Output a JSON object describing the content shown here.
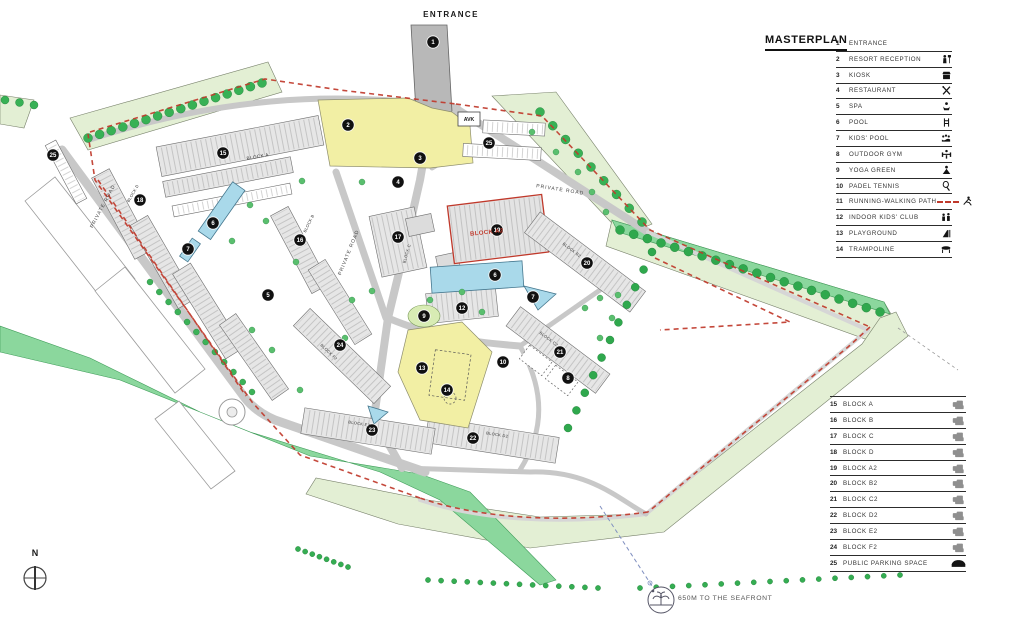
{
  "legend": {
    "title": "MASTERPLAN",
    "amenities": [
      {
        "n": "1",
        "label": "ENTRANCE",
        "icon": ""
      },
      {
        "n": "2",
        "label": "RESORT RECEPTION",
        "icon": "person"
      },
      {
        "n": "3",
        "label": "KIOSK",
        "icon": "kiosk"
      },
      {
        "n": "4",
        "label": "RESTAURANT",
        "icon": "restaurant"
      },
      {
        "n": "5",
        "label": "SPA",
        "icon": "spa"
      },
      {
        "n": "6",
        "label": "POOL",
        "icon": "pool"
      },
      {
        "n": "7",
        "label": "KIDS' POOL",
        "icon": "kids_pool"
      },
      {
        "n": "8",
        "label": "OUTDOOR GYM",
        "icon": "gym"
      },
      {
        "n": "9",
        "label": "YOGA GREEN",
        "icon": "yoga"
      },
      {
        "n": "10",
        "label": "PADEL TENNIS",
        "icon": "padel"
      },
      {
        "n": "11",
        "label": "RUNNING-WALKING PATH",
        "icon": "runner",
        "dashes": true
      },
      {
        "n": "12",
        "label": "INDOOR KIDS' CLUB",
        "icon": "kids_club"
      },
      {
        "n": "13",
        "label": "PLAYGROUND",
        "icon": "playground"
      },
      {
        "n": "14",
        "label": "TRAMPOLINE",
        "icon": "trampoline"
      }
    ],
    "blocks": [
      {
        "n": "15",
        "label": "BLOCK A",
        "icon": "building"
      },
      {
        "n": "16",
        "label": "BLOCK B",
        "icon": "building"
      },
      {
        "n": "17",
        "label": "BLOCK C",
        "icon": "building"
      },
      {
        "n": "18",
        "label": "BLOCK D",
        "icon": "building"
      },
      {
        "n": "19",
        "label": "BLOCK A2",
        "icon": "building"
      },
      {
        "n": "20",
        "label": "BLOCK B2",
        "icon": "building"
      },
      {
        "n": "21",
        "label": "BLOCK C2",
        "icon": "building"
      },
      {
        "n": "22",
        "label": "BLOCK D2",
        "icon": "building"
      },
      {
        "n": "23",
        "label": "BLOCK E2",
        "icon": "building"
      },
      {
        "n": "24",
        "label": "BLOCK F2",
        "icon": "building"
      },
      {
        "n": "25",
        "label": "PUBLIC PARKING SPACE",
        "icon": "car"
      }
    ]
  },
  "map": {
    "labels": [
      {
        "text": "ENTRANCE",
        "x": 451,
        "y": 17,
        "rot": 0,
        "color": "#1a1a1a",
        "size": 8,
        "bold": true,
        "ls": 1.4
      },
      {
        "text": "AVK",
        "x": 469,
        "y": 121,
        "rot": 0,
        "color": "#1a1a1a",
        "size": 5.2,
        "bold": true,
        "ls": 0
      },
      {
        "text": "PRIVATE ROAD",
        "x": 560,
        "y": 191,
        "rot": 9,
        "color": "#444444",
        "size": 5,
        "bold": false,
        "ls": 1
      },
      {
        "text": "PRIVATE ROAD",
        "x": 350,
        "y": 253,
        "rot": -68,
        "color": "#444444",
        "size": 5,
        "bold": false,
        "ls": 1
      },
      {
        "text": "PRIVATE ROAD",
        "x": 104,
        "y": 207,
        "rot": -62,
        "color": "#444444",
        "size": 5,
        "bold": false,
        "ls": 1
      },
      {
        "text": "BLOCK A",
        "x": 258,
        "y": 158,
        "rot": -10,
        "color": "#333333",
        "size": 4.6,
        "bold": false,
        "ls": 0.4
      },
      {
        "text": "BLOCK B",
        "x": 310,
        "y": 224,
        "rot": -64,
        "color": "#333333",
        "size": 4,
        "bold": false,
        "ls": 0.3
      },
      {
        "text": "BLOCK C",
        "x": 408,
        "y": 254,
        "rot": -74,
        "color": "#333333",
        "size": 4,
        "bold": false,
        "ls": 0.3
      },
      {
        "text": "BLOCK D",
        "x": 134,
        "y": 194,
        "rot": -60,
        "color": "#333333",
        "size": 4,
        "bold": false,
        "ls": 0.3
      },
      {
        "text": "BLOCK A2",
        "x": 487,
        "y": 234,
        "rot": -6,
        "color": "#c0392b",
        "size": 6,
        "bold": true,
        "ls": 0.4
      },
      {
        "text": "BLOCK B2",
        "x": 571,
        "y": 251,
        "rot": 37,
        "color": "#333333",
        "size": 4,
        "bold": false,
        "ls": 0.3
      },
      {
        "text": "BLOCK C2",
        "x": 548,
        "y": 340,
        "rot": 37,
        "color": "#333333",
        "size": 4,
        "bold": false,
        "ls": 0.3
      },
      {
        "text": "BLOCK D2",
        "x": 497,
        "y": 436,
        "rot": 9,
        "color": "#333333",
        "size": 4,
        "bold": false,
        "ls": 0.3
      },
      {
        "text": "BLOCK E2",
        "x": 359,
        "y": 425,
        "rot": 9,
        "color": "#333333",
        "size": 4,
        "bold": false,
        "ls": 0.3
      },
      {
        "text": "BLOCK F2",
        "x": 328,
        "y": 353,
        "rot": 44,
        "color": "#333333",
        "size": 4,
        "bold": false,
        "ls": 0.3
      },
      {
        "text": "650M TO THE SEAFRONT",
        "x": 678,
        "y": 600,
        "rot": 0,
        "color": "#555555",
        "size": 6.8,
        "bold": false,
        "ls": 0.6,
        "anchor": "start"
      },
      {
        "text": "N",
        "x": 35,
        "y": 556,
        "rot": 0,
        "color": "#1a1a1a",
        "size": 9,
        "bold": true,
        "ls": 0
      }
    ],
    "markers": [
      {
        "n": "1",
        "x": 433,
        "y": 42
      },
      {
        "n": "2",
        "x": 348,
        "y": 125
      },
      {
        "n": "3",
        "x": 420,
        "y": 158
      },
      {
        "n": "4",
        "x": 398,
        "y": 182
      },
      {
        "n": "5",
        "x": 268,
        "y": 295
      },
      {
        "n": "6",
        "x": 495,
        "y": 275
      },
      {
        "n": "6",
        "x": 213,
        "y": 223
      },
      {
        "n": "7",
        "x": 533,
        "y": 297
      },
      {
        "n": "7",
        "x": 188,
        "y": 249
      },
      {
        "n": "8",
        "x": 568,
        "y": 378
      },
      {
        "n": "9",
        "x": 424,
        "y": 316
      },
      {
        "n": "10",
        "x": 503,
        "y": 362
      },
      {
        "n": "12",
        "x": 462,
        "y": 308
      },
      {
        "n": "13",
        "x": 422,
        "y": 368
      },
      {
        "n": "14",
        "x": 447,
        "y": 390
      },
      {
        "n": "15",
        "x": 223,
        "y": 153
      },
      {
        "n": "16",
        "x": 300,
        "y": 240
      },
      {
        "n": "17",
        "x": 398,
        "y": 237
      },
      {
        "n": "18",
        "x": 140,
        "y": 200
      },
      {
        "n": "19",
        "x": 497,
        "y": 230
      },
      {
        "n": "20",
        "x": 587,
        "y": 263
      },
      {
        "n": "21",
        "x": 560,
        "y": 352
      },
      {
        "n": "22",
        "x": 473,
        "y": 438
      },
      {
        "n": "23",
        "x": 372,
        "y": 430
      },
      {
        "n": "24",
        "x": 340,
        "y": 345
      },
      {
        "n": "25",
        "x": 489,
        "y": 143
      },
      {
        "n": "25",
        "x": 53,
        "y": 155
      }
    ]
  },
  "colors": {
    "path_red": "#c0392b",
    "pale_green": "#e3efd4",
    "solid_green": "#8bd79d",
    "tree_green": "#38b155",
    "plaza_yellow": "#f2efa4",
    "pool_blue": "#a9d9ea",
    "road_gray": "#c8c8c8",
    "building_gray": "#e6e6e6",
    "seafront_blue": "#8090c0"
  }
}
